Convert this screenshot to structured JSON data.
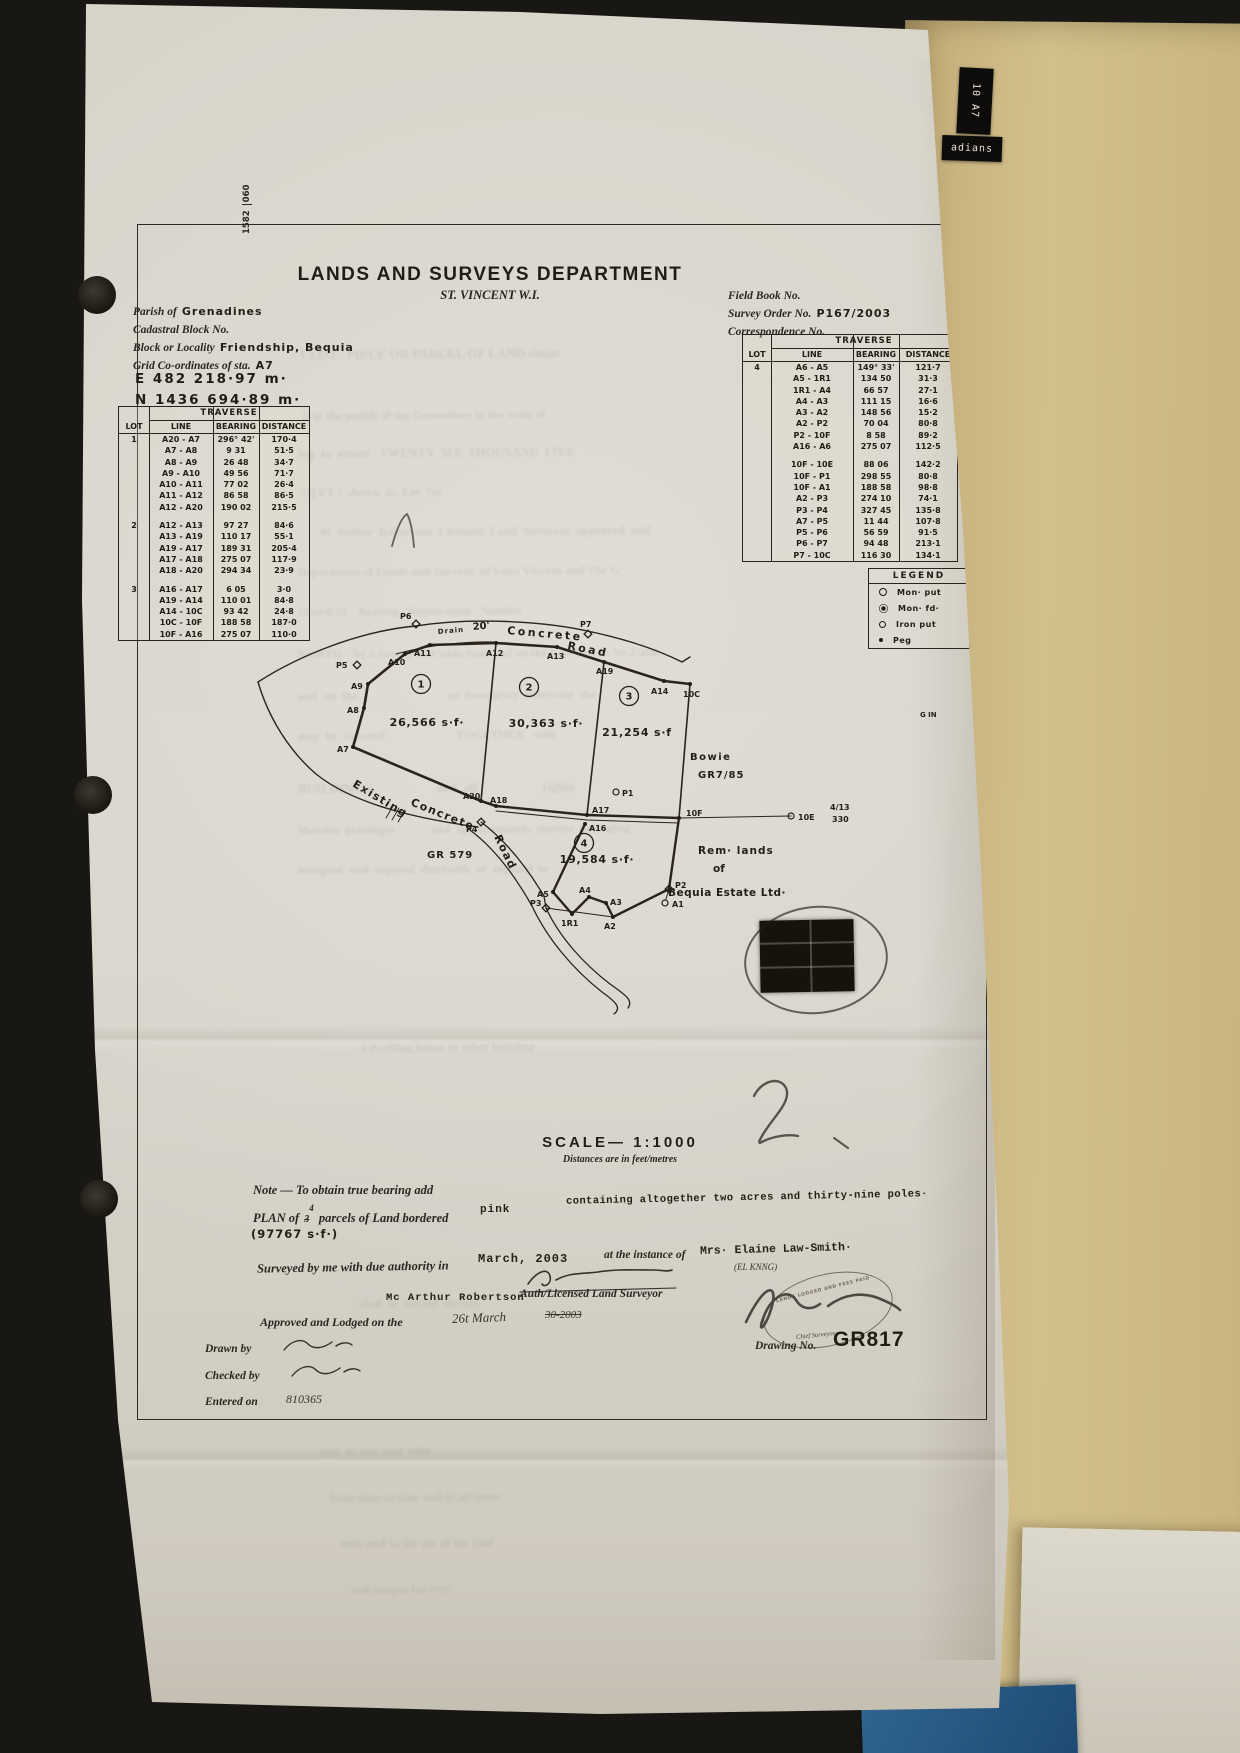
{
  "margin_ref": {
    "a": "1582",
    "b": "060"
  },
  "folder": {
    "tab_top": "10 A7",
    "tab_side": "adians"
  },
  "header": {
    "title": "LANDS AND SURVEYS DEPARTMENT",
    "subtitle": "ST. VINCENT W.I.",
    "parish_label": "Parish of",
    "parish_value": "Grenadines",
    "cadastral_label": "Cadastral Block No.",
    "locality_label": "Block or Locality",
    "locality_value": "Friendship, Bequia",
    "grid_label": "Grid Co-ordinates of sta.",
    "grid_value": "A7",
    "easting": "E 482 218·97 m·",
    "northing": "N 1436 694·89 m·",
    "field_book_label": "Field Book No.",
    "survey_order_label": "Survey Order No.",
    "survey_order_value": "P167/2003",
    "correspondence_label": "Correspondence No."
  },
  "tables": {
    "title": "TRAVERSE",
    "cols": [
      "LOT",
      "LINE",
      "BEARING",
      "DISTANCE"
    ],
    "left": {
      "groups": [
        {
          "lot": "1",
          "rows": [
            [
              "A20 - A7",
              "296° 42'",
              "170·4"
            ],
            [
              "A7 - A8",
              "9 31",
              "51·5"
            ],
            [
              "A8 - A9",
              "26 48",
              "34·7"
            ],
            [
              "A9 - A10",
              "49 56",
              "71·7"
            ],
            [
              "A10 - A11",
              "77 02",
              "26·4"
            ],
            [
              "A11 - A12",
              "86 58",
              "86·5"
            ],
            [
              "A12 - A20",
              "190 02",
              "215·5"
            ]
          ]
        },
        {
          "lot": "2",
          "rows": [
            [
              "A12 - A13",
              "97 27",
              "84·6"
            ],
            [
              "A13 - A19",
              "110 17",
              "55·1"
            ],
            [
              "A19 - A17",
              "189 31",
              "205·4"
            ],
            [
              "A17 - A18",
              "275 07",
              "117·9"
            ],
            [
              "A18 - A20",
              "294 34",
              "23·9"
            ]
          ]
        },
        {
          "lot": "3",
          "rows": [
            [
              "A16 - A17",
              "6 05",
              "3·0"
            ],
            [
              "A19 - A14",
              "110 01",
              "84·8"
            ],
            [
              "A14 - 10C",
              "93 42",
              "24·8"
            ],
            [
              "10C - 10F",
              "188 58",
              "187·0"
            ],
            [
              "10F - A16",
              "275 07",
              "110·0"
            ]
          ]
        }
      ]
    },
    "right": {
      "groups": [
        {
          "lot": "4",
          "rows": [
            [
              "A6 - A5",
              "149° 33'",
              "121·7"
            ],
            [
              "A5 - 1R1",
              "134 50",
              "31·3"
            ],
            [
              "1R1 - A4",
              "66 57",
              "27·1"
            ],
            [
              "A4 - A3",
              "111 15",
              "16·6"
            ],
            [
              "A3 - A2",
              "148 56",
              "15·2"
            ],
            [
              "A2 - P2",
              "70 04",
              "80·8"
            ],
            [
              "P2 - 10F",
              "8 58",
              "89·2"
            ],
            [
              "A16 - A6",
              "275 07",
              "112·5"
            ]
          ]
        },
        {
          "lot": "",
          "rows": [
            [
              "10F - 10E",
              "88 06",
              "142·2"
            ],
            [
              "10F - P1",
              "298 55",
              "80·8"
            ],
            [
              "10F - A1",
              "188 58",
              "98·8"
            ],
            [
              "A2 - P3",
              "274 10",
              "74·1"
            ],
            [
              "P3 - P4",
              "327 45",
              "135·8"
            ],
            [
              "A7 - P5",
              "11 44",
              "107·8"
            ],
            [
              "P5 - P6",
              "56 59",
              "91·5"
            ],
            [
              "P6 - P7",
              "94 48",
              "213·1"
            ],
            [
              "P7 - 10C",
              "116 30",
              "134·1"
            ]
          ]
        }
      ]
    }
  },
  "legend": {
    "title": "LEGEND",
    "items": [
      {
        "sym": "mon-put",
        "label": "Mon· put"
      },
      {
        "sym": "mon-fd",
        "label": "Mon· fd·"
      },
      {
        "sym": "iron-put",
        "label": "Iron put"
      },
      {
        "sym": "peg",
        "label": "Peg"
      }
    ]
  },
  "plan": {
    "lots": [
      {
        "num": "1",
        "cx": 421,
        "cy": 684,
        "area": "26,566 s·f·",
        "ax": 427,
        "ay": 726
      },
      {
        "num": "2",
        "cx": 529,
        "cy": 687,
        "area": "30,363 s·f·",
        "ax": 546,
        "ay": 727
      },
      {
        "num": "3",
        "cx": 629,
        "cy": 696,
        "area": "21,254 s·f",
        "ax": 637,
        "ay": 736
      },
      {
        "num": "4",
        "cx": 584,
        "cy": 843,
        "area": "19,584 s·f·",
        "ax": 597,
        "ay": 863
      }
    ],
    "points": [
      {
        "n": "P6",
        "x": 416,
        "y": 624,
        "m": "diamond",
        "lx": 400,
        "ly": 619
      },
      {
        "n": "P7",
        "x": 588,
        "y": 634,
        "m": "diamond",
        "lx": 580,
        "ly": 627
      },
      {
        "n": "P5",
        "x": 357,
        "y": 665,
        "m": "diamond",
        "lx": 336,
        "ly": 668
      },
      {
        "n": "P4",
        "x": 481,
        "y": 822,
        "m": "diamond",
        "lx": 466,
        "ly": 832
      },
      {
        "n": "P3",
        "x": 546,
        "y": 908,
        "m": "diamond",
        "lx": 530,
        "ly": 906
      },
      {
        "n": "P2",
        "x": 669,
        "y": 889,
        "m": "diamond",
        "lx": 675,
        "ly": 888
      },
      {
        "n": "P1",
        "x": 616,
        "y": 792,
        "m": "open",
        "lx": 622,
        "ly": 796
      },
      {
        "n": "10E",
        "x": 791,
        "y": 816,
        "m": "open",
        "lx": 798,
        "ly": 820
      },
      {
        "n": "A1",
        "x": 665,
        "y": 903,
        "m": "open",
        "lx": 672,
        "ly": 907
      },
      {
        "n": "10C",
        "x": 690,
        "y": 684,
        "m": "dot",
        "lx": 683,
        "ly": 697
      },
      {
        "n": "10F",
        "x": 679,
        "y": 818,
        "m": "dot",
        "lx": 686,
        "ly": 816
      },
      {
        "n": "A7",
        "x": 353,
        "y": 747,
        "m": "dot",
        "lx": 337,
        "ly": 752
      },
      {
        "n": "A8",
        "x": 364,
        "y": 708,
        "m": "dot",
        "lx": 347,
        "ly": 713
      },
      {
        "n": "A9",
        "x": 368,
        "y": 684,
        "m": "dot",
        "lx": 351,
        "ly": 689
      },
      {
        "n": "A10",
        "x": 405,
        "y": 654,
        "m": "dot",
        "lx": 388,
        "ly": 665
      },
      {
        "n": "A11",
        "x": 430,
        "y": 645,
        "m": "dot",
        "lx": 414,
        "ly": 656
      },
      {
        "n": "A12",
        "x": 496,
        "y": 643,
        "m": "dot",
        "lx": 486,
        "ly": 656
      },
      {
        "n": "A13",
        "x": 557,
        "y": 647,
        "m": "dot",
        "lx": 547,
        "ly": 659
      },
      {
        "n": "A19",
        "x": 604,
        "y": 662,
        "m": "dot",
        "lx": 596,
        "ly": 674
      },
      {
        "n": "A14",
        "x": 664,
        "y": 681,
        "m": "dot",
        "lx": 651,
        "ly": 694
      },
      {
        "n": "A20",
        "x": 481,
        "y": 801,
        "m": "dot",
        "lx": 463,
        "ly": 799
      },
      {
        "n": "A18",
        "x": 496,
        "y": 806,
        "m": "dot",
        "lx": 490,
        "ly": 803
      },
      {
        "n": "A17",
        "x": 587,
        "y": 815,
        "m": "dot",
        "lx": 592,
        "ly": 813
      },
      {
        "n": "A16",
        "x": 585,
        "y": 824,
        "m": "dot",
        "lx": 589,
        "ly": 831
      },
      {
        "n": "A5",
        "x": 553,
        "y": 892,
        "m": "dot",
        "lx": 537,
        "ly": 897
      },
      {
        "n": "1R1",
        "x": 572,
        "y": 914,
        "m": "dot",
        "lx": 561,
        "ly": 926
      },
      {
        "n": "A4",
        "x": 589,
        "y": 897,
        "m": "dot",
        "lx": 579,
        "ly": 893
      },
      {
        "n": "A3",
        "x": 606,
        "y": 903,
        "m": "dot",
        "lx": 610,
        "ly": 905
      },
      {
        "n": "A2",
        "x": 613,
        "y": 917,
        "m": "dot",
        "lx": 604,
        "ly": 929
      }
    ],
    "labels": [
      {
        "t": "Drain",
        "x": 438,
        "y": 634,
        "s": 7,
        "r": -5,
        "ls": 1
      },
      {
        "t": "20'",
        "x": 473,
        "y": 630,
        "s": 10,
        "r": -5
      },
      {
        "t": "Concrete",
        "x": 507,
        "y": 634,
        "s": 11,
        "r": 5,
        "ls": 2.5
      },
      {
        "t": "Road",
        "x": 567,
        "y": 649,
        "s": 11,
        "r": 11,
        "ls": 2.5
      },
      {
        "t": "Existing",
        "x": 352,
        "y": 786,
        "s": 11,
        "r": 31,
        "ls": 1.5
      },
      {
        "t": "Concrete",
        "x": 410,
        "y": 805,
        "s": 11,
        "r": 22,
        "ls": 1.5
      },
      {
        "t": "Road",
        "x": 494,
        "y": 837,
        "s": 11,
        "r": 64,
        "ls": 1.5
      },
      {
        "t": "GR 579",
        "x": 427,
        "y": 858,
        "s": 10,
        "ls": 1
      },
      {
        "t": "Bowie",
        "x": 690,
        "y": 760,
        "s": 10,
        "ls": 1.5
      },
      {
        "t": "GR7/85",
        "x": 698,
        "y": 778,
        "s": 10,
        "ls": 1
      },
      {
        "t": "Rem· lands",
        "x": 698,
        "y": 854,
        "s": 10.5,
        "ls": 1
      },
      {
        "t": "of",
        "x": 713,
        "y": 872,
        "s": 10.5
      },
      {
        "t": "Bequia Estate Ltd·",
        "x": 668,
        "y": 896,
        "s": 10.5,
        "ls": 0.5
      },
      {
        "t": "G IN",
        "x": 920,
        "y": 717,
        "s": 7
      },
      {
        "t": "4/13",
        "x": 830,
        "y": 810,
        "s": 8
      },
      {
        "t": "330",
        "x": 832,
        "y": 822,
        "s": 8
      }
    ]
  },
  "footer": {
    "scale": "SCALE— 1:1000",
    "units": "Distances are in feet/metres",
    "note": "Note — To obtain true bearing add",
    "plan_prefix": "PLAN of",
    "plan_num_old": "3",
    "plan_num_new": "4",
    "plan_suffix": "parcels of Land bordered",
    "border_color_word": "pink",
    "containing": "containing altogether two acres and thirty-nine poles·",
    "total_area": "(97767 s·f·)",
    "surveyed_label": "Surveyed by me with due authority in",
    "survey_date": "March, 2003",
    "instance_label": "at the instance of",
    "client": "Mrs· Elaine Law-Smith·",
    "client_note": "(EL KNNG)",
    "surveyor_name": "Mc Arthur Robertson",
    "surveyor_title": "Auth/Licensed Land Surveyor",
    "approved_label": "Approved and Lodged on the",
    "approved_date_a": "26t March",
    "approved_date_b": "30-2003",
    "drawn_label": "Drawn by",
    "checked_label": "Checked by",
    "entered_label": "Entered on",
    "entered_value": "810365",
    "drawing_no_label": "Drawing No.",
    "drawing_no": "GR817",
    "stamp_text": "LANDS LODGED AND FEES PAID",
    "chief_title": "Chief Surveyor"
  },
  "bleed": [
    [
      "T LOT   PIECE OR PARCEL OF LAND situat",
      298,
      346,
      13
    ],
    [
      "is in the parish of the Grenadines in the State of",
      302,
      408,
      12
    ],
    [
      "ing  to  extent   TWENTY  SIX  THOUSAND  FIVE",
      298,
      446,
      12.5
    ],
    [
      "SQ FT )  shown  as  Lot  No",
      300,
      485,
      12
    ],
    [
      "M  Arthur  Robertson  Licensed  Land  Surveyor  approved  and",
      320,
      524,
      12
    ],
    [
      "Department of Lands and Surveys  of Saint Vincent and The G",
      298,
      564,
      12
    ],
    [
      "March 20    bearing   Registration   Number",
      298,
      604,
      12
    ],
    [
      "NORTH    by a twenty foot wide road and on the East by Lot No 2 and",
      298,
      646,
      12
    ],
    [
      "and  on  the                              or  howsoever  otherwise  the",
      298,
      688,
      12
    ],
    [
      "may  be  situated                        TOGETHER   with",
      298,
      728,
      12
    ],
    [
      "BUILDINGS                    and  all                    rights",
      298,
      780,
      13
    ],
    [
      "liberties  privileges            and  appurtenances  thereto  belonging",
      298,
      822,
      12
    ],
    [
      "occupied  and  enjoyed  therewith  or  reputed  to",
      298,
      862,
      12
    ],
    [
      "a dwelling house or other building",
      360,
      1040,
      12
    ],
    [
      "for  occupation  by",
      360,
      1214,
      11
    ],
    [
      "shall  be  erected  thereon",
      360,
      1298,
      11
    ],
    [
      "and  to  cut  and  take",
      320,
      1444,
      12
    ],
    [
      "from time to time and at all times",
      330,
      1490,
      12
    ],
    [
      "unto and to the use of the said",
      340,
      1536,
      12
    ],
    [
      "and assigns for ever",
      350,
      1582,
      12
    ]
  ]
}
